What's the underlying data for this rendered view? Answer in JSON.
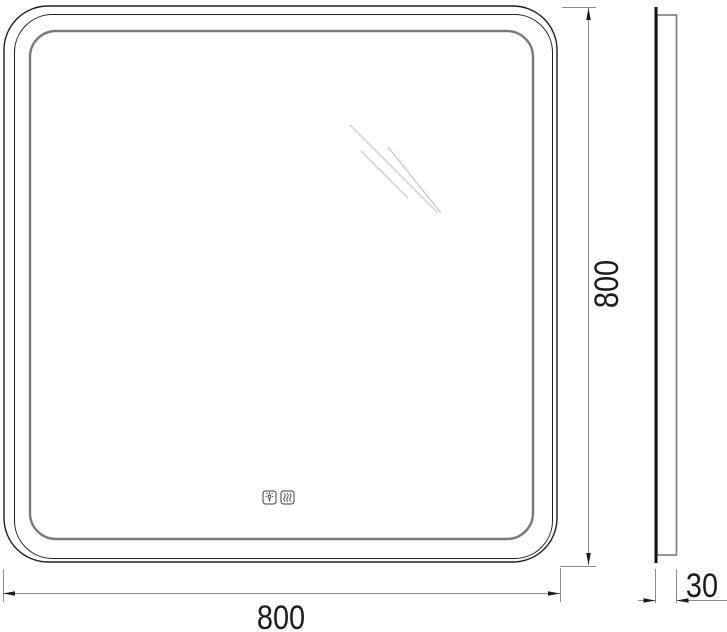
{
  "dimensions": {
    "width": {
      "label": "800"
    },
    "height": {
      "label": "800"
    },
    "depth": {
      "label": "30"
    }
  },
  "front_view": {
    "touch_controls": [
      {
        "icon": "light-icon",
        "meaning": "light toggle"
      },
      {
        "icon": "heater-icon",
        "meaning": "anti-fog heater toggle"
      }
    ]
  },
  "colors": {
    "outline": "#1f1f1f",
    "led_ring": "#7a7a7a",
    "side_body": "#7a7a7a",
    "dimension_lines": "#8a8a8a",
    "arrows_text": "#1c1c1c",
    "reflection": "#c4c4c4",
    "background": "#ffffff"
  }
}
